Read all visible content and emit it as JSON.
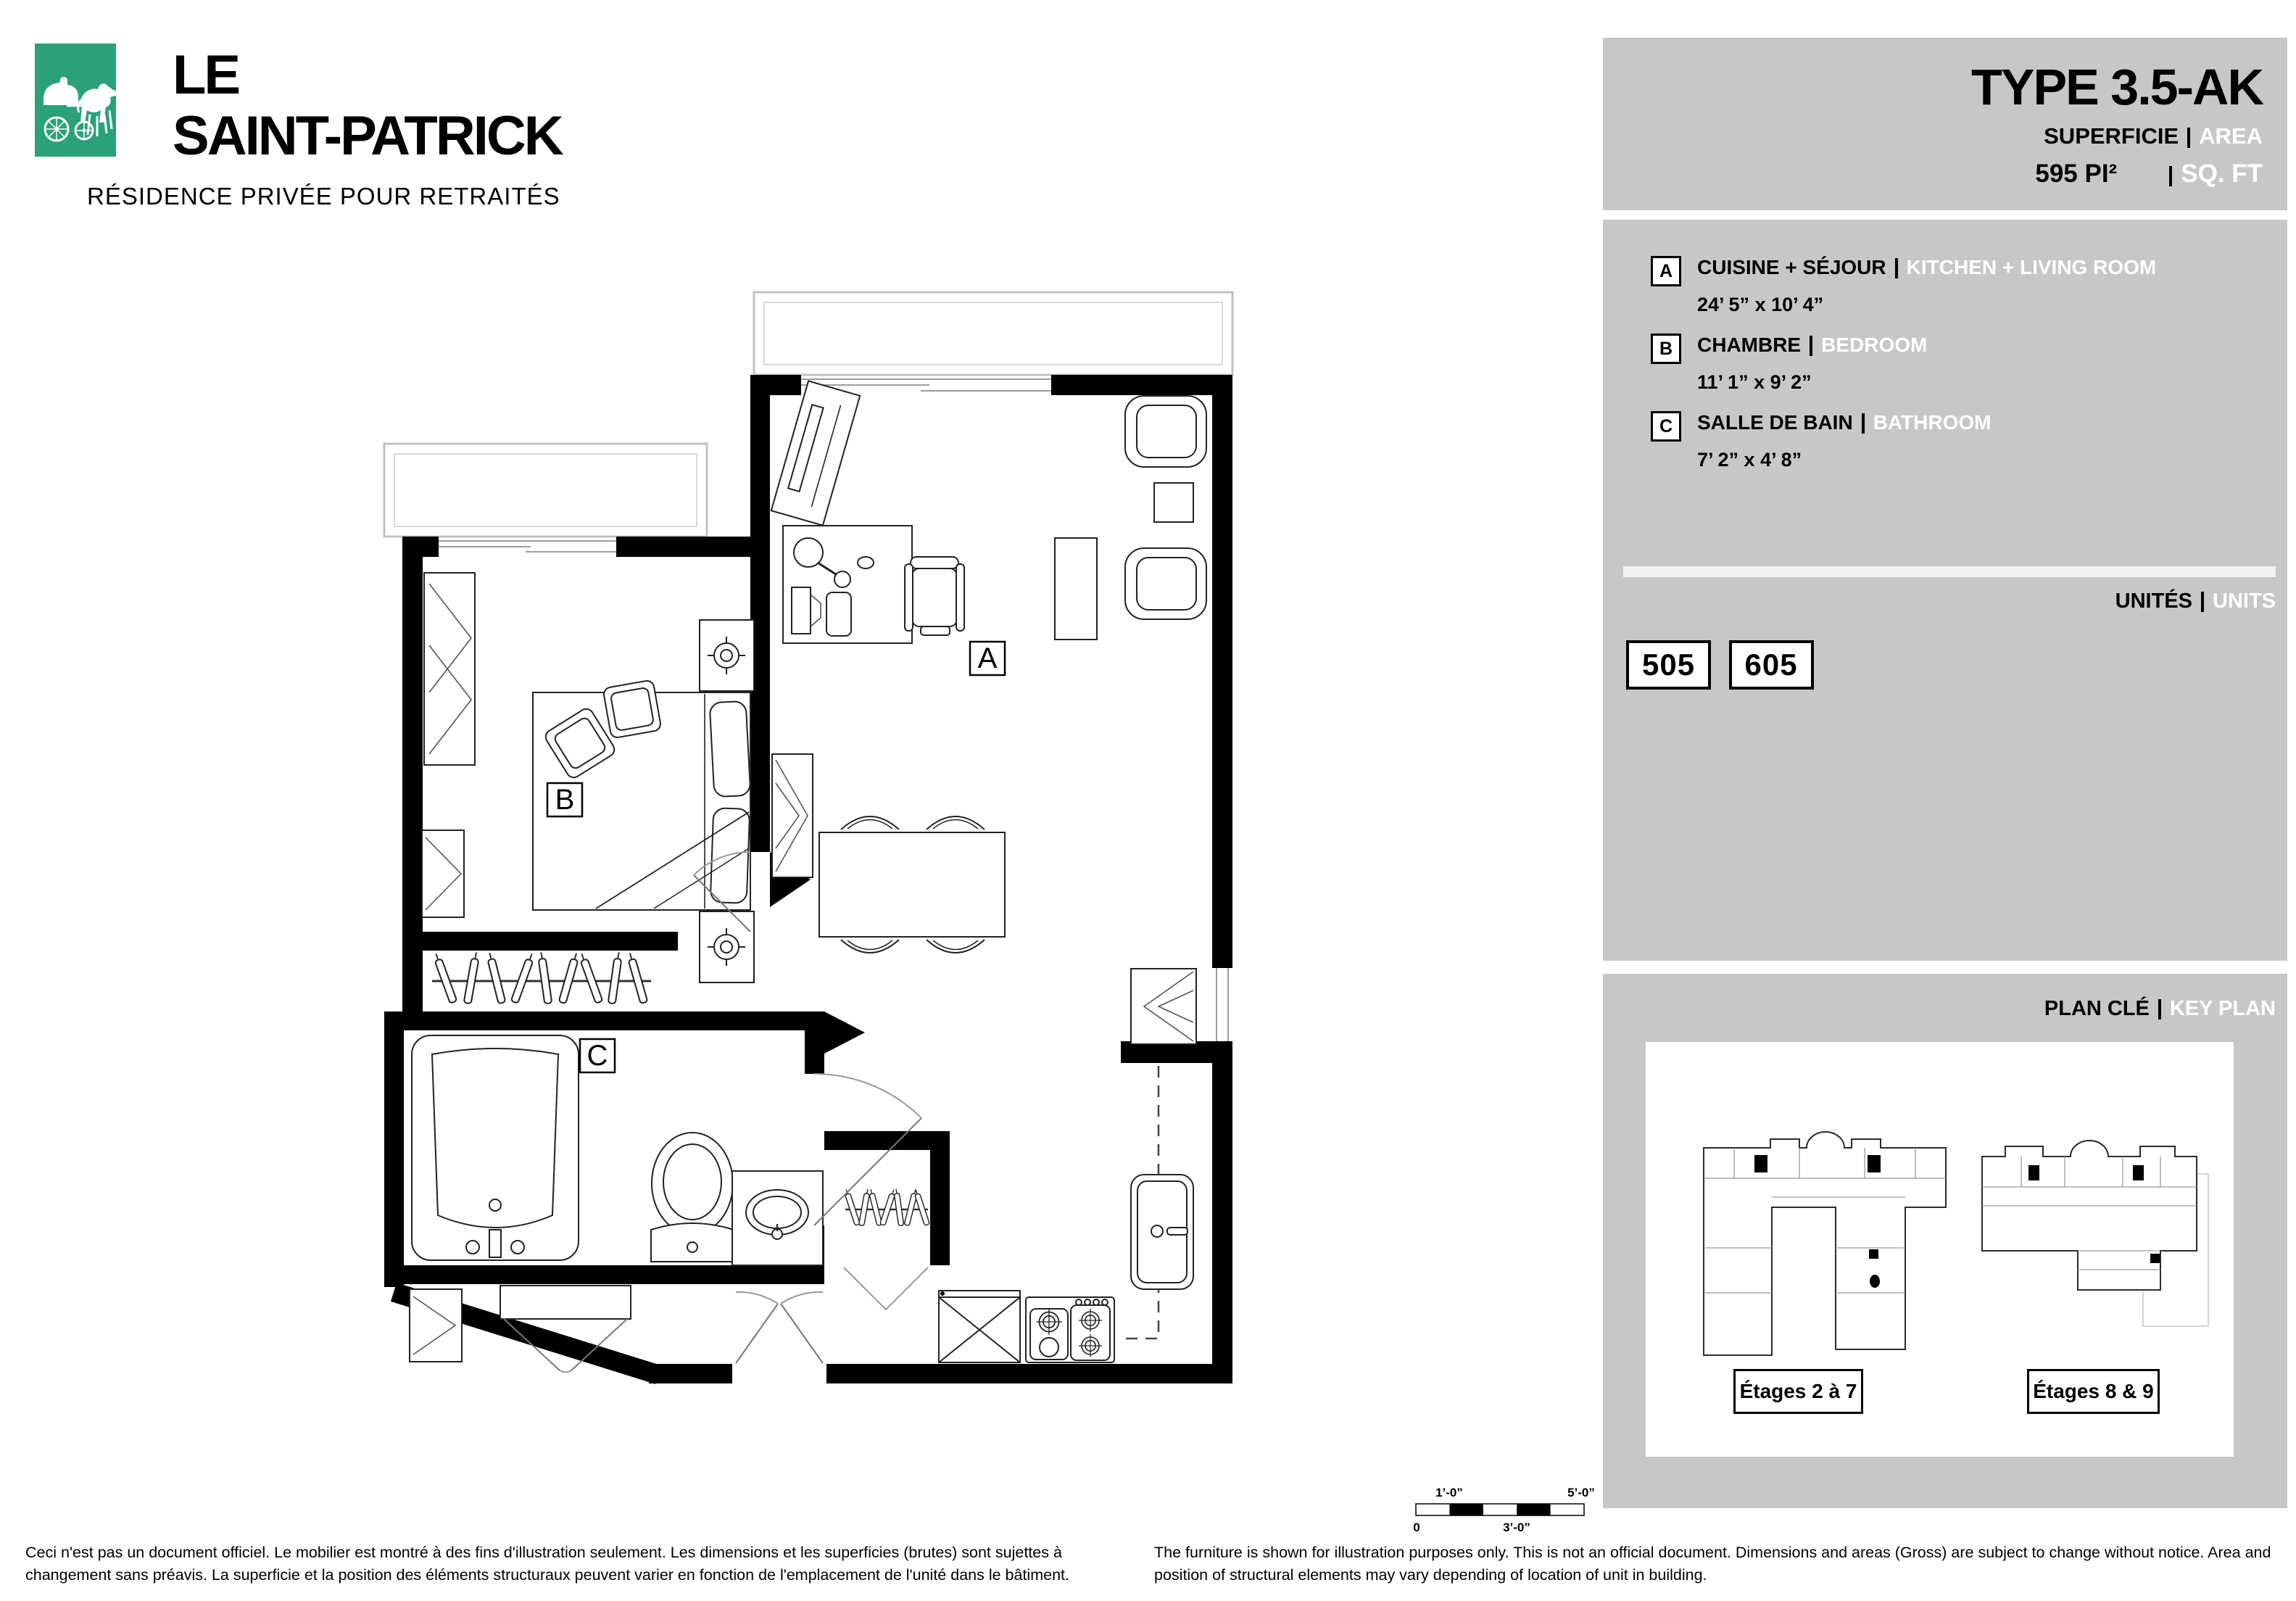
{
  "logo": {
    "line1": "LE",
    "line2": "SAINT-PATRICK",
    "tagline": "RÉSIDENCE PRIVÉE POUR RETRAITÉS",
    "icon": "horse-carriage-icon",
    "green": "#2aa179"
  },
  "header": {
    "title": "TYPE 3.5-AK",
    "area_label_fr": "SUPERFICIE",
    "area_label_en": "AREA",
    "area_value": "595 PI²",
    "area_unit_en": "SQ. FT"
  },
  "legend": {
    "items": [
      {
        "key": "A",
        "name_fr": "CUISINE + SÉJOUR",
        "name_en": "KITCHEN + LIVING ROOM",
        "dims": "24’ 5” x 10’ 4”"
      },
      {
        "key": "B",
        "name_fr": "CHAMBRE",
        "name_en": "BEDROOM",
        "dims": "11’ 1” x 9’ 2”"
      },
      {
        "key": "C",
        "name_fr": "SALLE DE BAIN",
        "name_en": "BATHROOM",
        "dims": "7’ 2” x 4’ 8”"
      }
    ]
  },
  "units": {
    "label_fr": "UNITÉS",
    "label_en": "UNITS",
    "numbers": [
      "505",
      "605"
    ]
  },
  "keyplan": {
    "label_fr": "PLAN CLÉ",
    "label_en": "KEY PLAN",
    "captions": [
      "Étages 2 à 7",
      "Étages 8 & 9"
    ]
  },
  "plan": {
    "room_labels": [
      "A",
      "B",
      "C"
    ]
  },
  "scalebar": {
    "top_left": "1’-0”",
    "top_right": "5’-0”",
    "bottom_left": "0",
    "bottom_mid": "3’-0”"
  },
  "disclaimer": {
    "fr": "Ceci n'est pas un document officiel. Le mobilier est montré à des fins d'illustration seulement. Les dimensions et les superficies (brutes) sont sujettes à changement sans préavis. La superficie et la position des éléments structuraux peuvent varier en fonction de l'emplacement de l'unité dans le bâtiment.",
    "en": "The furniture is shown for illustration purposes only. This is not an official document. Dimensions and areas (Gross) are subject to change without notice. Area and position of structural elements may vary depending of location of unit in building."
  },
  "colors": {
    "panel_gray": "#c7c7c7",
    "divider_light": "#f1f1f1",
    "logo_green": "#2aa179"
  }
}
